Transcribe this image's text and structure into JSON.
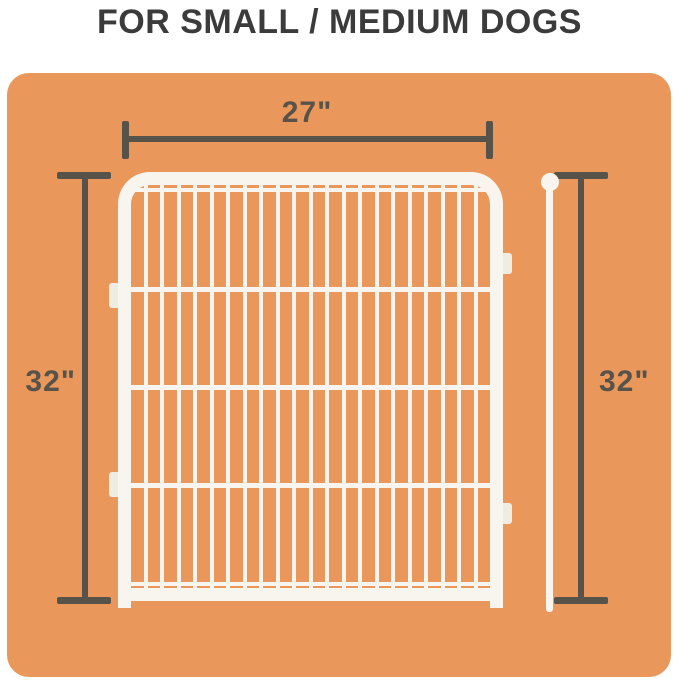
{
  "title": "FOR SMALL / MEDIUM DOGS",
  "dimensions": {
    "panel_width_label": "27\"",
    "panel_height_label": "32\"",
    "pole_height_label": "32\""
  },
  "illustration": {
    "wire_count": 21,
    "crossbar_count": 3
  },
  "colors": {
    "card_background": "#E9975B",
    "panel_white": "#F7F5EE",
    "tab_white": "#EFEDE3",
    "dimension_gray": "#57524A",
    "title_color": "#3B3B3B",
    "page_background": "#FFFFFF"
  }
}
